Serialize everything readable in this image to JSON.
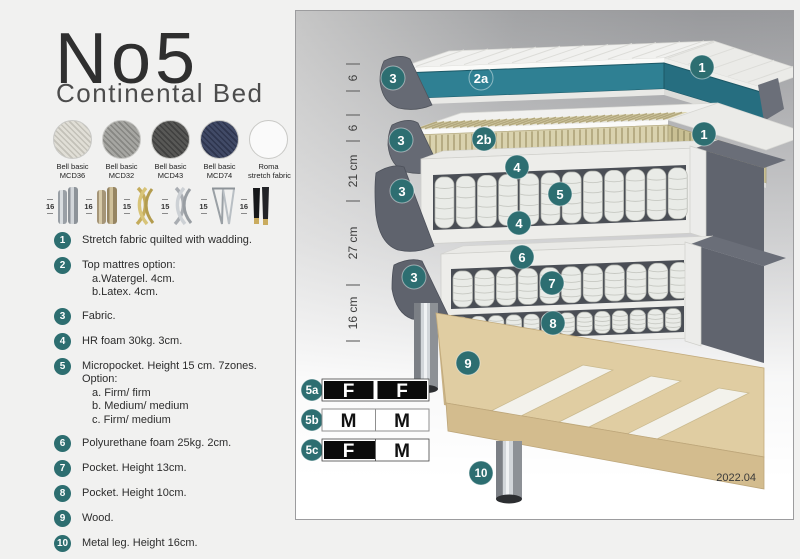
{
  "page": {
    "title": "No5",
    "subtitle": "Continental Bed",
    "version": "2022.04"
  },
  "fabrics": [
    {
      "line1": "Bell basic",
      "line2": "MCD36",
      "color": "#e0ded6"
    },
    {
      "line1": "Bell basic",
      "line2": "MCD32",
      "color": "#a6a6a2"
    },
    {
      "line1": "Bell basic",
      "line2": "MCD43",
      "color": "#585856"
    },
    {
      "line1": "Bell basic",
      "line2": "MCD74",
      "color": "#414a66"
    },
    {
      "line1": "Roma",
      "line2": "stretch fabric",
      "color": "#fafafa"
    }
  ],
  "legs": [
    {
      "height": "16",
      "type": "steel-cylinder-leg"
    },
    {
      "height": "16",
      "type": "brass-cylinder-leg"
    },
    {
      "height": "15",
      "type": "gold-twist-leg"
    },
    {
      "height": "15",
      "type": "silver-twist-leg"
    },
    {
      "height": "15",
      "type": "hairpin-leg"
    },
    {
      "height": "16",
      "type": "black-taper-leg"
    }
  ],
  "features": [
    {
      "num": "1",
      "text": "Stretch fabric quilted with wadding.",
      "sub": []
    },
    {
      "num": "2",
      "text": "Top mattres option:",
      "sub": [
        "a.Watergel. 4cm.",
        "b.Latex. 4cm."
      ]
    },
    {
      "num": "3",
      "text": "Fabric.",
      "sub": []
    },
    {
      "num": "4",
      "text": "HR foam 30kg. 3cm.",
      "sub": []
    },
    {
      "num": "5",
      "text": "Micropocket. Height 15 cm. 7zones. Option:",
      "sub": [
        "a. Firm/ firm",
        "b. Medium/ medium",
        "c. Firm/ medium"
      ]
    },
    {
      "num": "6",
      "text": "Polyurethane foam 25kg. 2cm.",
      "sub": []
    },
    {
      "num": "7",
      "text": "Pocket. Height 13cm.",
      "sub": []
    },
    {
      "num": "8",
      "text": "Pocket. Height 10cm.",
      "sub": []
    },
    {
      "num": "9",
      "text": "Wood.",
      "sub": []
    },
    {
      "num": "10",
      "text": "Metal leg. Height 16cm.",
      "sub": []
    }
  ],
  "diagram": {
    "measurements": [
      "6",
      "6",
      "21 cm",
      "27 cm",
      "16 cm"
    ],
    "callouts": {
      "c1": "1",
      "c2a": "2a",
      "c2b": "2b",
      "c3": "3",
      "c4": "4",
      "c5": "5",
      "c6": "6",
      "c7": "7",
      "c8": "8",
      "c9": "9",
      "c10": "10"
    },
    "firmness": [
      {
        "label": "5a",
        "cells": [
          {
            "letter": "F",
            "style": "dark"
          },
          {
            "letter": "F",
            "style": "dark"
          }
        ]
      },
      {
        "label": "5b",
        "cells": [
          {
            "letter": "M",
            "style": "light"
          },
          {
            "letter": "M",
            "style": "light"
          }
        ]
      },
      {
        "label": "5c",
        "cells": [
          {
            "letter": "F",
            "style": "dark"
          },
          {
            "letter": "M",
            "style": "light"
          }
        ]
      }
    ]
  },
  "colors": {
    "accent_teal": "#2d6e70",
    "band_teal": "#2f8093",
    "latex": "#d9d2ae",
    "fabric_gray": "#63676f",
    "wood": "#e0cda2",
    "panel_border": "#9c9c9e"
  }
}
